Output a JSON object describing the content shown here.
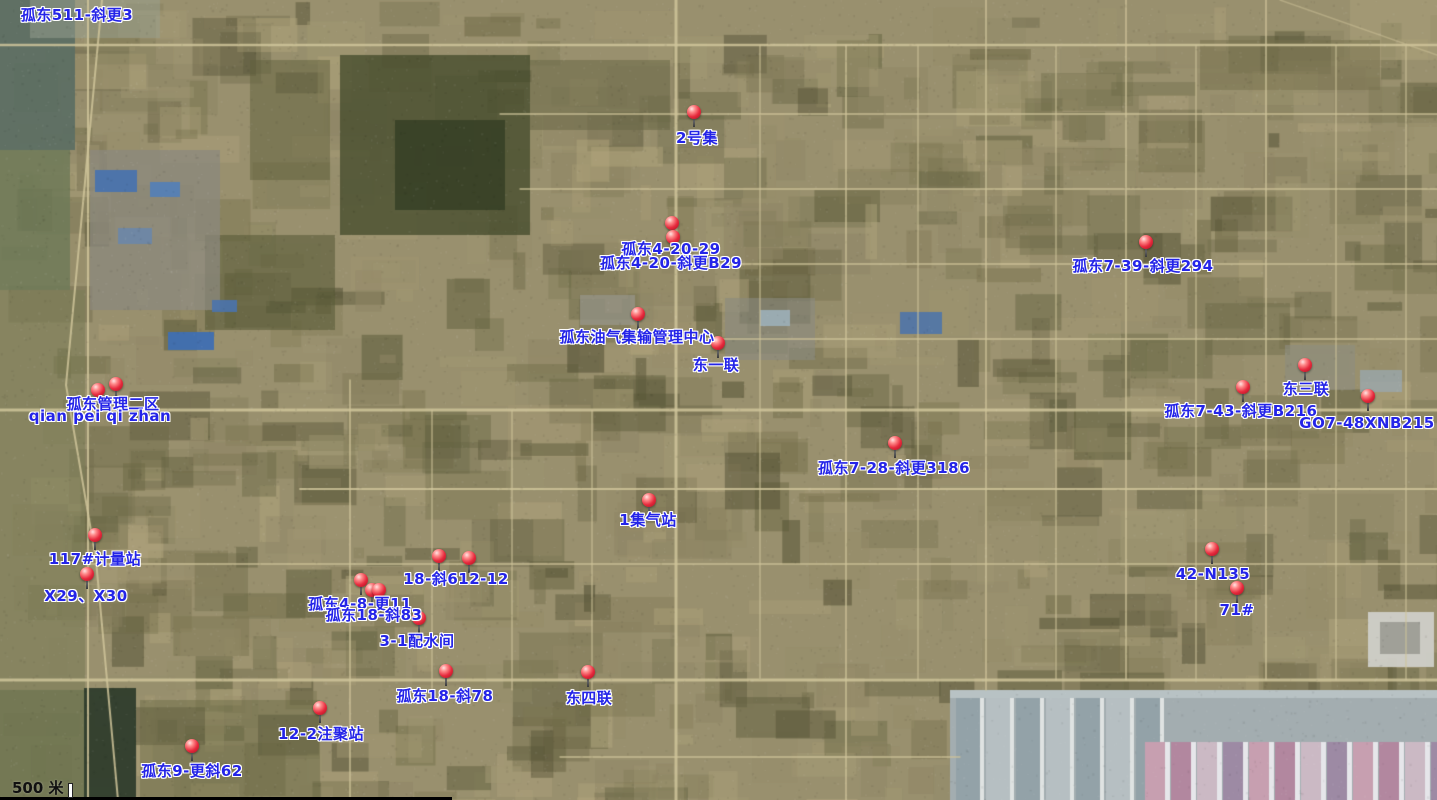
{
  "map": {
    "scale_bar": {
      "label": "500 米"
    },
    "colors": {
      "label_text": "#2424e8",
      "pin_red": "#e6293c",
      "basemap_ground": "#99906e"
    },
    "labels": [
      {
        "text": "孤东511-斜更3",
        "x": 77,
        "y": 15
      },
      {
        "text": "2号集",
        "x": 697,
        "y": 138
      },
      {
        "text": "孤东4-20-29",
        "x": 671,
        "y": 249
      },
      {
        "text": "孤东4-20-斜更B29",
        "x": 671,
        "y": 263
      },
      {
        "text": "孤东7-39-斜更294",
        "x": 1143,
        "y": 266
      },
      {
        "text": "孤东油气集输管理中心",
        "x": 637,
        "y": 337
      },
      {
        "text": "东一联",
        "x": 716,
        "y": 365
      },
      {
        "text": "东三联",
        "x": 1306,
        "y": 389
      },
      {
        "text": "孤东7-43-斜更B216",
        "x": 1241,
        "y": 411
      },
      {
        "text": "GO7-48XNB215",
        "x": 1367,
        "y": 423
      },
      {
        "text": "孤东管理二区",
        "x": 113,
        "y": 404
      },
      {
        "text": "qian pei qi zhan",
        "x": 100,
        "y": 416
      },
      {
        "text": "孤东7-28-斜更3186",
        "x": 894,
        "y": 468
      },
      {
        "text": "1集气站",
        "x": 648,
        "y": 520
      },
      {
        "text": "117#计量站",
        "x": 95,
        "y": 559
      },
      {
        "text": "X29、X30",
        "x": 86,
        "y": 596
      },
      {
        "text": "18-斜612-12",
        "x": 456,
        "y": 579
      },
      {
        "text": "孤东4-8-更11",
        "x": 360,
        "y": 604
      },
      {
        "text": "孤东18-斜83",
        "x": 374,
        "y": 615
      },
      {
        "text": "3-1配水间",
        "x": 417,
        "y": 641
      },
      {
        "text": "42-N135",
        "x": 1213,
        "y": 574
      },
      {
        "text": "71#",
        "x": 1237,
        "y": 610
      },
      {
        "text": "孤东18-斜78",
        "x": 445,
        "y": 696
      },
      {
        "text": "东四联",
        "x": 589,
        "y": 698
      },
      {
        "text": "12-2注聚站",
        "x": 321,
        "y": 734
      },
      {
        "text": "孤东9-更斜62",
        "x": 192,
        "y": 771
      }
    ],
    "pins": [
      {
        "x": 694,
        "y": 112
      },
      {
        "x": 672,
        "y": 223
      },
      {
        "x": 673,
        "y": 237
      },
      {
        "x": 1146,
        "y": 242
      },
      {
        "x": 638,
        "y": 314
      },
      {
        "x": 718,
        "y": 343
      },
      {
        "x": 1305,
        "y": 365
      },
      {
        "x": 1243,
        "y": 387
      },
      {
        "x": 1368,
        "y": 396
      },
      {
        "x": 98,
        "y": 390
      },
      {
        "x": 116,
        "y": 384
      },
      {
        "x": 895,
        "y": 443
      },
      {
        "x": 649,
        "y": 500
      },
      {
        "x": 95,
        "y": 535
      },
      {
        "x": 87,
        "y": 574
      },
      {
        "x": 439,
        "y": 556
      },
      {
        "x": 469,
        "y": 558
      },
      {
        "x": 361,
        "y": 580
      },
      {
        "x": 372,
        "y": 590
      },
      {
        "x": 379,
        "y": 590
      },
      {
        "x": 419,
        "y": 618
      },
      {
        "x": 1212,
        "y": 549
      },
      {
        "x": 1237,
        "y": 588
      },
      {
        "x": 446,
        "y": 671
      },
      {
        "x": 588,
        "y": 672
      },
      {
        "x": 320,
        "y": 708
      },
      {
        "x": 192,
        "y": 746
      }
    ]
  }
}
